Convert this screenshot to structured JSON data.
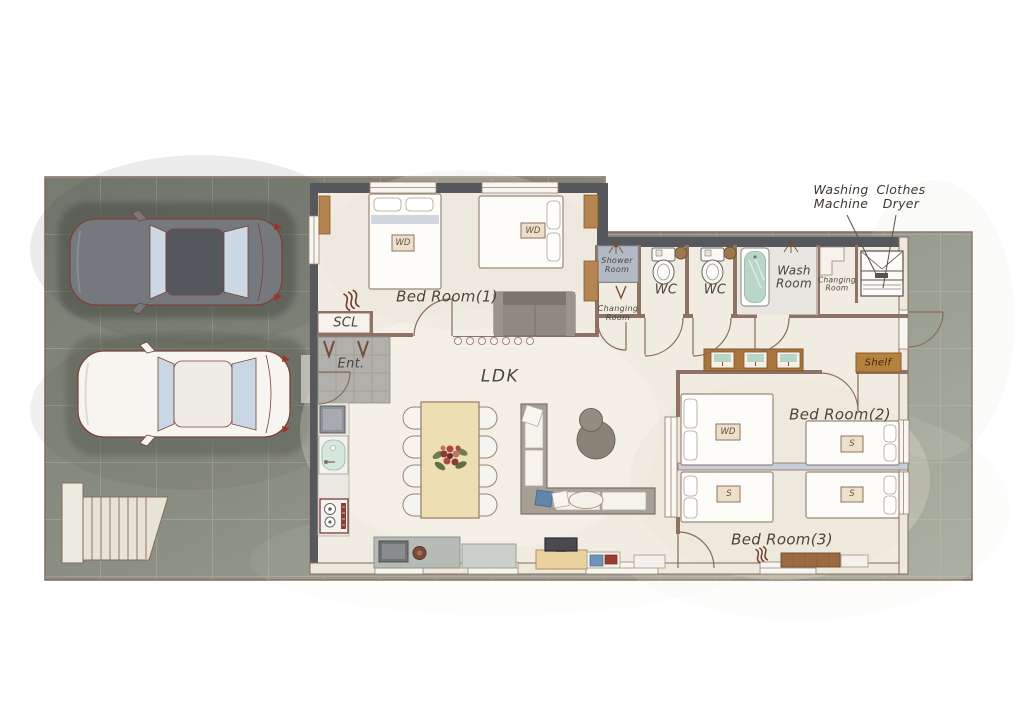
{
  "labels": {
    "bedroom1": "Bed Room(1)",
    "bedroom2": "Bed Room(2)",
    "bedroom3": "Bed Room(3)",
    "ldk": "LDK",
    "wc": "WC",
    "wash_room": "Wash Room",
    "shower_room": "Shower Room",
    "changing_room": "Changing Room",
    "shoe_closet": "SCL",
    "entrance": "Ent.",
    "shelf": "Shelf",
    "washing_machine": "Washing Machine",
    "clothes_dryer": "Clothes Dryer",
    "bed_double_tag": "WD",
    "bed_single_tag": "S"
  },
  "colors": {
    "page_bg": "#ffffff",
    "site_concrete": "#8b8f83",
    "house_floor": "#f1ece2",
    "exterior_wall": "#56585d",
    "interior_wall": "#8d7265",
    "wood_accent": "#b5813f",
    "dining_table": "#eedfb2",
    "bath_green": "#b9d6c6",
    "bed_divider": "#c6ccd8",
    "car_dark": "#75787d",
    "car_white": "#f7f5f0",
    "label_text": "#4c443c"
  }
}
